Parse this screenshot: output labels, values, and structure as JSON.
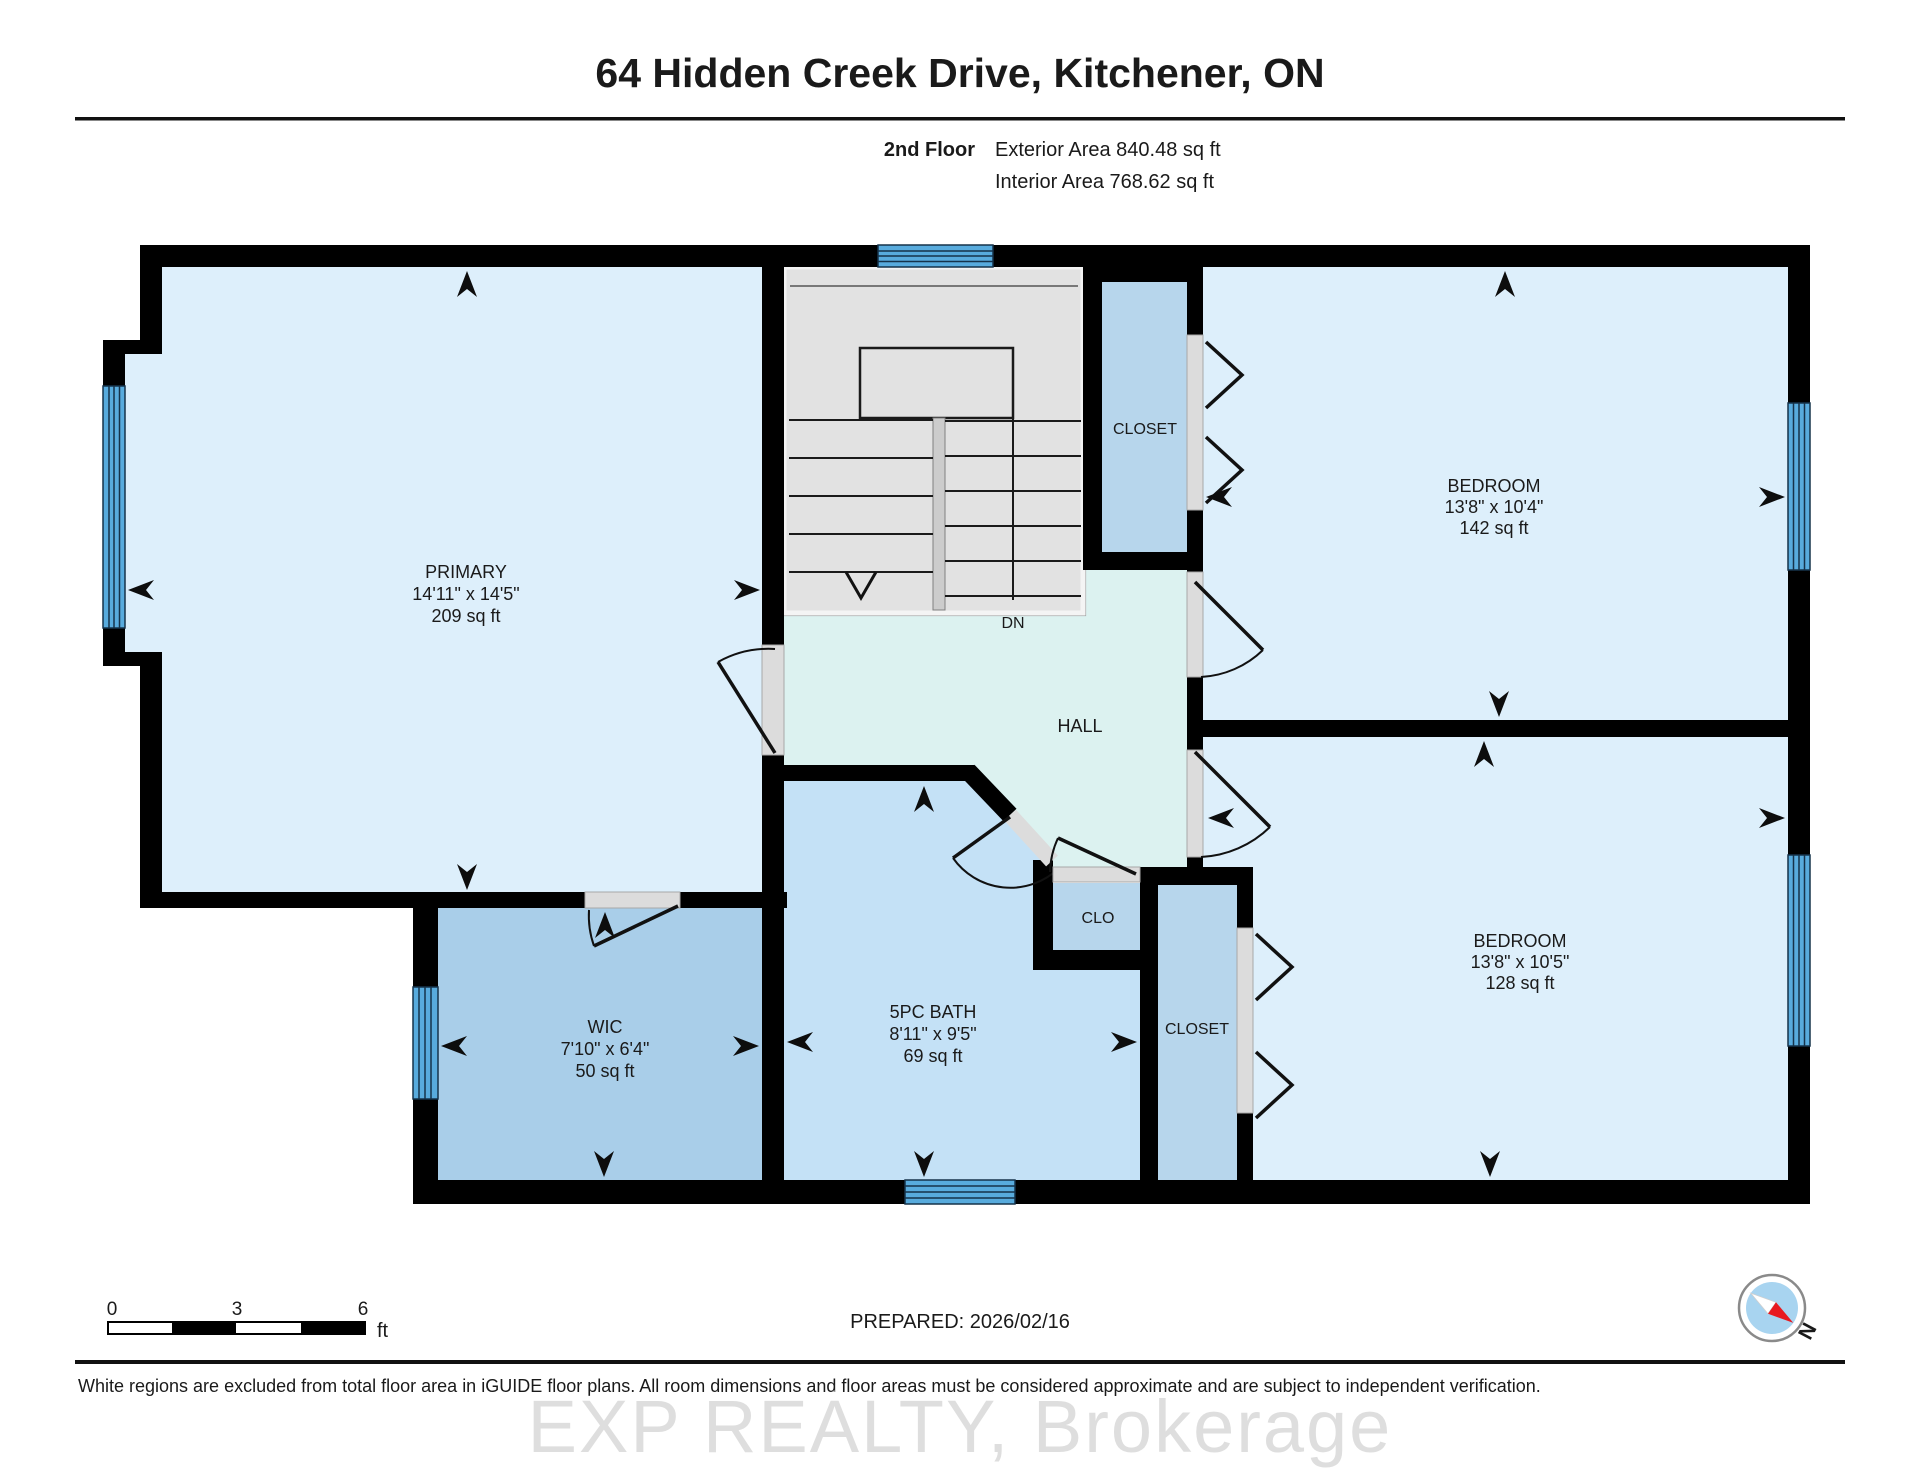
{
  "header": {
    "title": "64 Hidden Creek Drive, Kitchener, ON",
    "floor_label": "2nd Floor",
    "exterior_area": "Exterior Area 840.48 sq ft",
    "interior_area": "Interior Area 768.62 sq ft"
  },
  "rooms": {
    "primary": {
      "name": "PRIMARY",
      "dims": "14'11\" x 14'5\"",
      "area": "209 sq ft"
    },
    "bedroom_top_right": {
      "name": "BEDROOM",
      "dims": "13'8\" x 10'4\"",
      "area": "142 sq ft"
    },
    "bedroom_bottom_right": {
      "name": "BEDROOM",
      "dims": "13'8\" x 10'5\"",
      "area": "128 sq ft"
    },
    "wic": {
      "name": "WIC",
      "dims": "7'10\" x 6'4\"",
      "area": "50 sq ft"
    },
    "bath": {
      "name": "5PC BATH",
      "dims": "8'11\" x 9'5\"",
      "area": "69 sq ft"
    },
    "hall": {
      "name": "HALL"
    },
    "closet_top": {
      "name": "CLOSET"
    },
    "closet_bottom": {
      "name": "CLOSET"
    },
    "clo": {
      "name": "CLO"
    },
    "stair_direction": "DN"
  },
  "scale_bar": {
    "tick_0": "0",
    "tick_3": "3",
    "tick_6": "6",
    "unit": "ft"
  },
  "footer": {
    "prepared": "PREPARED: 2026/02/16",
    "disclaimer": "White regions are excluded from total floor area in iGUIDE floor plans. All room dimensions and floor areas must be considered approximate and are subject to independent verification.",
    "watermark": "EXP REALTY, Brokerage"
  },
  "compass": {
    "north_label": "N"
  },
  "colors": {
    "wall": "#000000",
    "room_light": "#ddeffb",
    "bath_fill": "#c4e1f6",
    "wic_fill": "#a9cee9",
    "closet_fill": "#b7d6ec",
    "hall_fill": "#dcf2f0",
    "stairs_fill": "#e2e2e2",
    "door_fill": "#dcdcdc",
    "window_blue": "#58abdd",
    "compass_red": "#e8191f",
    "compass_blue": "#a8d4f0"
  }
}
